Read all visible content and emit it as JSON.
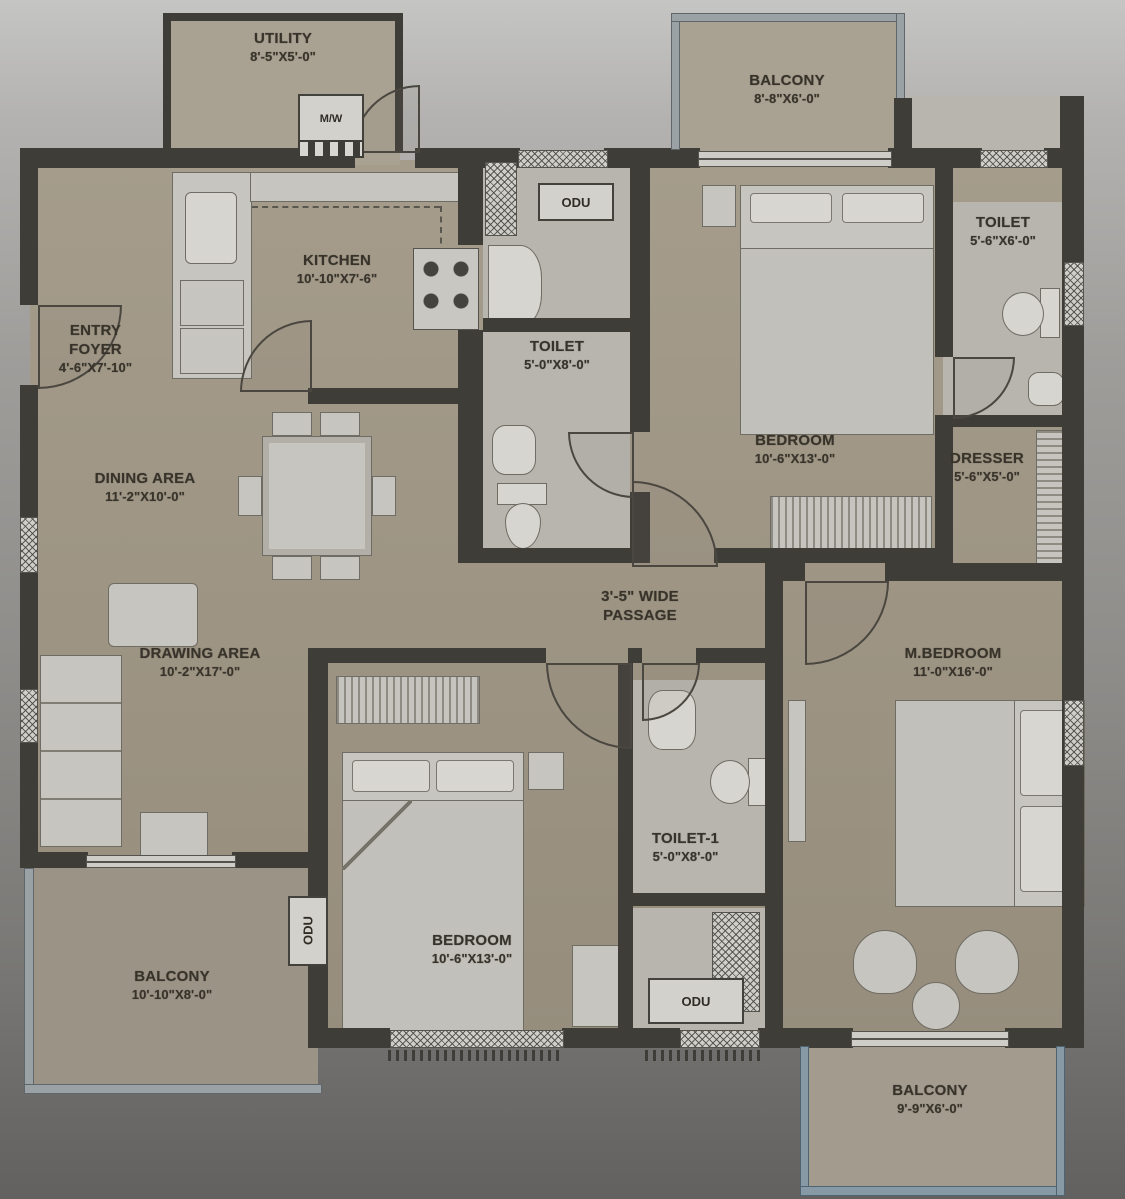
{
  "plan_type": "apartment-floor-plan",
  "rooms": {
    "utility": {
      "name": "UTILITY",
      "dims": "8'-5\"X5'-0\""
    },
    "balcony_top": {
      "name": "BALCONY",
      "dims": "8'-8\"X6'-0\""
    },
    "kitchen": {
      "name": "KITCHEN",
      "dims": "10'-10\"X7'-6\""
    },
    "entry_foyer": {
      "name": "ENTRY FOYER",
      "dims": "4'-6\"X7'-10\""
    },
    "toilet_mid": {
      "name": "TOILET",
      "dims": "5'-0\"X8'-0\""
    },
    "toilet_top_right": {
      "name": "TOILET",
      "dims": "5'-6\"X6'-0\""
    },
    "bedroom_top": {
      "name": "BEDROOM",
      "dims": "10'-6\"X13'-0\""
    },
    "dresser": {
      "name": "DRESSER",
      "dims": "5'-6\"X5'-0\""
    },
    "dining": {
      "name": "DINING AREA",
      "dims": "11'-2\"X10'-0\""
    },
    "passage": {
      "line1": "3'-5\" WIDE",
      "line2": "PASSAGE"
    },
    "drawing": {
      "name": "DRAWING AREA",
      "dims": "10'-2\"X17'-0\""
    },
    "m_bedroom": {
      "name": "M.BEDROOM",
      "dims": "11'-0\"X16'-0\""
    },
    "toilet_1": {
      "name": "TOILET-1",
      "dims": "5'-0\"X8'-0\""
    },
    "bedroom_bottom": {
      "name": "BEDROOM",
      "dims": "10'-6\"X13'-0\""
    },
    "balcony_bottom_left": {
      "name": "BALCONY",
      "dims": "10'-10\"X8'-0\""
    },
    "balcony_bottom_right": {
      "name": "BALCONY",
      "dims": "9'-9\"X6'-0\""
    }
  },
  "labels": {
    "odu": "ODU",
    "mw": "M/W"
  },
  "colors": {
    "wall": "#3f3d38",
    "floor_main": "#a39a89",
    "floor_wet": "#b8b5af",
    "furniture": "#c7c5bf",
    "railing": "#8799a4",
    "text": "#37332a",
    "background": "#9e9d9a"
  }
}
